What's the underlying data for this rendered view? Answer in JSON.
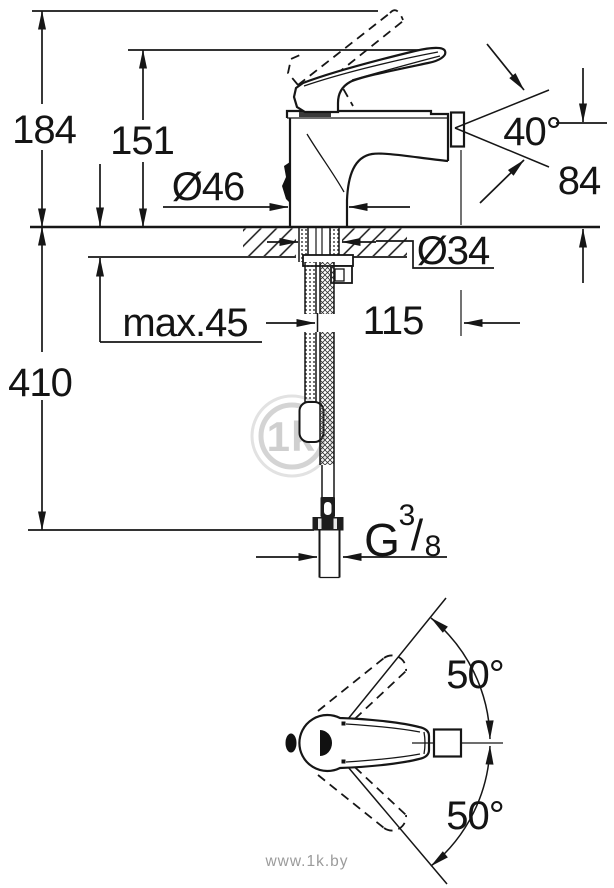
{
  "side_view": {
    "dim_total_height": "184",
    "dim_lever_height": "151",
    "dim_base_diameter": "Ø46",
    "dim_spray_angle": "40°",
    "dim_spout_height": "84",
    "dim_mounting_hole": "Ø34",
    "dim_max_deck": "max.45",
    "dim_spout_reach": "115",
    "dim_hose_length": "410",
    "thread": {
      "prefix": "G",
      "numerator": "3",
      "slash": "/",
      "denominator": "8"
    }
  },
  "top_view": {
    "dim_swivel_upper": "50°",
    "dim_swivel_lower": "50°"
  },
  "watermark": {
    "logo": "1k",
    "site": "www.1k.by"
  },
  "colors": {
    "ink": "#161616",
    "watermark_logo": "#cfcfcf",
    "watermark_site": "#9b9b9b",
    "background": "#ffffff"
  }
}
